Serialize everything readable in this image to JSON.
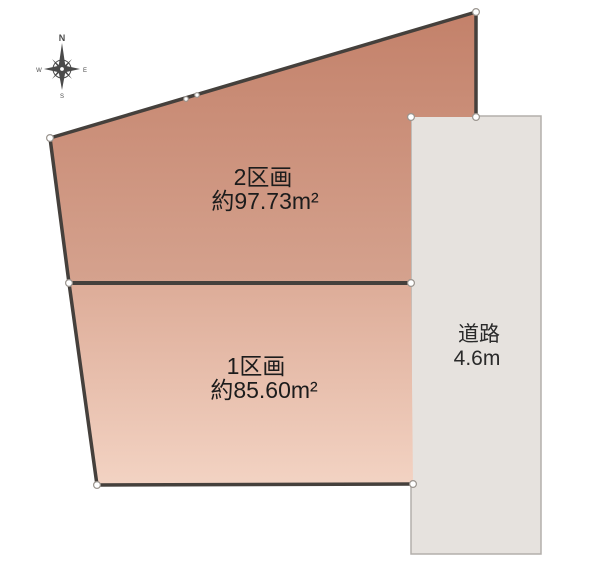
{
  "diagram": {
    "type": "land-plot-layout",
    "background": "#ffffff",
    "compass": {
      "north_label": "N",
      "west_label": "W",
      "east_label": "E",
      "south_label": "S",
      "color": "#4a4a4a"
    },
    "parcels": [
      {
        "name": "2区画",
        "area": "約97.73m²",
        "fill_top": "#c3816a",
        "fill_bottom": "#d5a28e"
      },
      {
        "name": "1区画",
        "area": "約85.60m²",
        "fill_top": "#ddac98",
        "fill_bottom": "#f3d3c3"
      }
    ],
    "road": {
      "name": "道路",
      "width_label": "4.6m",
      "fill": "#e6e2de",
      "border": "#b3afab",
      "label_color": "#2a2a2a"
    },
    "outline_color": "#45403c",
    "label_color": "#1c1c1c",
    "marker": {
      "fill": "#ffffff",
      "stroke": "#9a948e"
    }
  }
}
